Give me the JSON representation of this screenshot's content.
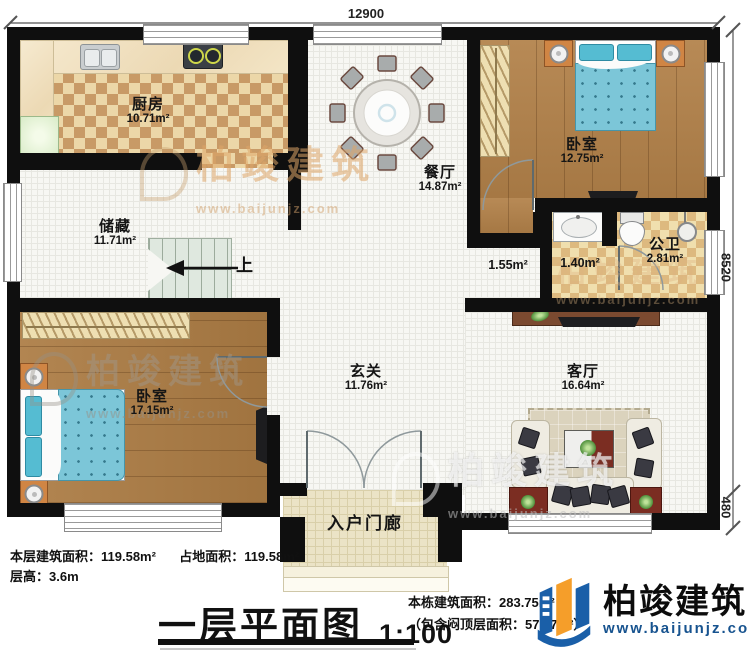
{
  "dimensions": {
    "top": "12900",
    "right_upper": "8520",
    "right_lower": "480"
  },
  "rooms": [
    {
      "id": "kitchen",
      "name": "厨房",
      "area": "10.71m²"
    },
    {
      "id": "dining",
      "name": "餐厅",
      "area": "14.87m²"
    },
    {
      "id": "bedroom1",
      "name": "卧室",
      "area": "12.75m²"
    },
    {
      "id": "storage",
      "name": "储藏",
      "area": "11.71m²"
    },
    {
      "id": "corridor",
      "name": "",
      "area": "1.55m²"
    },
    {
      "id": "washroom",
      "name": "",
      "area": "1.40m²"
    },
    {
      "id": "bathroom",
      "name": "公卫",
      "area": "2.81m²"
    },
    {
      "id": "bedroom2",
      "name": "卧室",
      "area": "17.15m²"
    },
    {
      "id": "foyer",
      "name": "玄关",
      "area": "11.76m²"
    },
    {
      "id": "living",
      "name": "客厅",
      "area": "16.64m²"
    },
    {
      "id": "porch",
      "name": "入户门廊",
      "area": ""
    }
  ],
  "stairs": {
    "up_label": "上"
  },
  "footer": {
    "floor_area": "本层建筑面积：119.58m²",
    "land_area": "占地面积：119.58m²",
    "floor_height": "层高：3.6m",
    "title": "一层平面图",
    "scale": "1:100",
    "total_area": "本栋建筑面积：283.75m²",
    "attic_note": "（包含闷顶层面积：57.07m²）"
  },
  "logo": {
    "brand": "柏竣建筑",
    "url": "www.baijunjz.com"
  },
  "watermark": {
    "text": "柏竣建筑",
    "url": "www.baijunjz.com"
  },
  "colors": {
    "wall": "#0f0f0f",
    "brand_blue": "#1a5fa8",
    "brand_orange": "#f59e2a",
    "bed_blue": "#7cc6d8",
    "wood": "#b28149",
    "kitchen_checker": "#c89a66"
  }
}
